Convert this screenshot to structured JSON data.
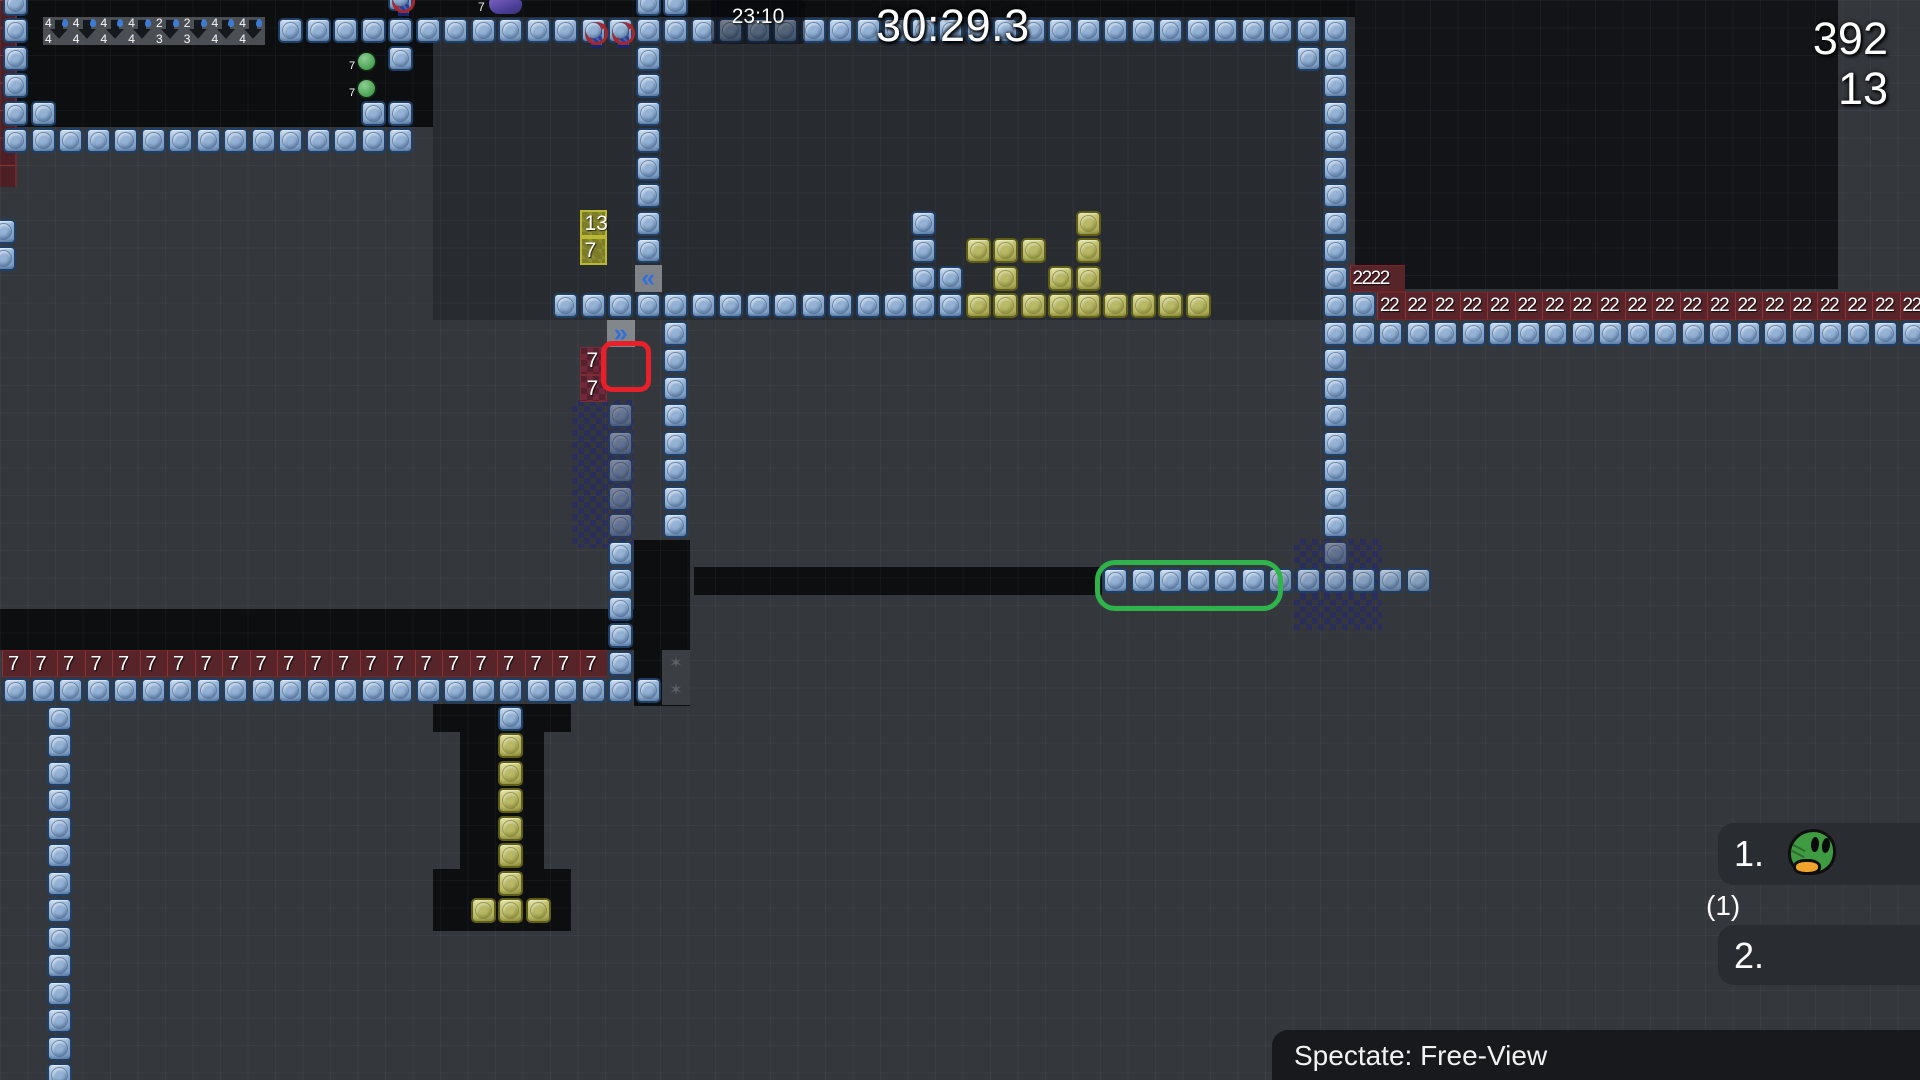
{
  "hud": {
    "clock": "23:10",
    "timer": "30:29.3",
    "counter_primary": "392",
    "counter_secondary": "13",
    "spectate_label": "Spectate: Free-View",
    "leaderboard": {
      "first_rank": "1.",
      "first_avatar": "green-duck",
      "first_sub": "(1)",
      "second_rank": "2."
    }
  },
  "colors": {
    "outer_bg": "#34373c",
    "central_room": "#282b30",
    "dark_room": "#0c0e10",
    "right_room": "#121417",
    "block_blue": "#9cb9da",
    "block_yellow": "#c5c573",
    "hazard_red": "#57242a",
    "checker_navy": "#262673",
    "accent_green": "#2fb34b",
    "accent_red": "#e8202a",
    "chevron_blue": "#2f6fe0",
    "duck_green": "#3f9b41",
    "beak_orange": "#f1a42c"
  },
  "map": {
    "tile": 27.5,
    "ox": 2,
    "oy": 17,
    "regions": [
      {
        "name": "top-strip",
        "x": 0,
        "y": 0,
        "w": 1838,
        "h": 17,
        "color": "#0c0e10"
      },
      {
        "name": "room-topleft",
        "x": 14,
        "y": 17,
        "w": 419,
        "h": 110,
        "color": "#0c0e10"
      },
      {
        "name": "room-central",
        "x": 433,
        "y": 17,
        "w": 890,
        "h": 303,
        "color": "#282b30"
      },
      {
        "name": "room-right",
        "x": 1355,
        "y": 0,
        "w": 483,
        "h": 289,
        "color": "#121417"
      },
      {
        "name": "strip-left",
        "x": 0,
        "y": 609,
        "w": 634,
        "h": 41,
        "color": "#0c0e10"
      },
      {
        "name": "pocket-mid",
        "x": 634,
        "y": 540,
        "w": 56,
        "h": 166,
        "color": "#0c0e10"
      },
      {
        "name": "corridor",
        "x": 694,
        "y": 567,
        "w": 408,
        "h": 28,
        "color": "#0c0e10"
      },
      {
        "name": "t-top",
        "x": 433,
        "y": 704,
        "w": 138,
        "h": 28,
        "color": "#0c0e10"
      },
      {
        "name": "t-shaft",
        "x": 460,
        "y": 732,
        "w": 84,
        "h": 166,
        "color": "#0c0e10"
      },
      {
        "name": "t-bottom",
        "x": 433,
        "y": 869,
        "w": 138,
        "h": 62,
        "color": "#0c0e10"
      }
    ],
    "checkers": [
      {
        "x": 572,
        "y": 400,
        "w": 62,
        "h": 148
      },
      {
        "x": 1294,
        "y": 539,
        "w": 88,
        "h": 29
      },
      {
        "x": 1294,
        "y": 567,
        "w": 88,
        "h": 28
      },
      {
        "x": 1294,
        "y": 594,
        "w": 88,
        "h": 36
      }
    ],
    "red_strip": {
      "x": 0,
      "y": 0,
      "w": 15,
      "h": 187
    },
    "arrow_strip": {
      "x": 43,
      "y": 17,
      "w": 222,
      "h": 28,
      "cells": [
        [
          "4",
          "4"
        ],
        [
          "4",
          "4"
        ],
        [
          "4",
          "4"
        ],
        [
          "4",
          "4"
        ],
        [
          "2",
          "3"
        ],
        [
          "2",
          "3"
        ],
        [
          "4",
          "4"
        ],
        [
          "4",
          "4"
        ]
      ]
    },
    "blue": [
      [
        0,
        -1
      ],
      [
        23,
        -1
      ],
      [
        24,
        -1
      ],
      [
        10,
        0
      ],
      [
        11,
        0
      ],
      [
        12,
        0
      ],
      [
        13,
        0
      ],
      [
        14,
        0
      ],
      [
        15,
        0
      ],
      [
        16,
        0
      ],
      [
        17,
        0
      ],
      [
        18,
        0
      ],
      [
        19,
        0
      ],
      [
        20,
        0
      ],
      [
        23,
        0
      ],
      [
        24,
        0
      ],
      [
        25,
        0
      ],
      [
        26,
        0
      ],
      [
        27,
        0
      ],
      [
        28,
        0
      ],
      [
        29,
        0
      ],
      [
        30,
        0
      ],
      [
        31,
        0
      ],
      [
        32,
        0
      ],
      [
        33,
        0
      ],
      [
        34,
        0
      ],
      [
        35,
        0
      ],
      [
        36,
        0
      ],
      [
        37,
        0
      ],
      [
        38,
        0
      ],
      [
        39,
        0
      ],
      [
        40,
        0
      ],
      [
        41,
        0
      ],
      [
        42,
        0
      ],
      [
        43,
        0
      ],
      [
        44,
        0
      ],
      [
        45,
        0
      ],
      [
        46,
        0
      ],
      [
        47,
        0
      ],
      [
        48,
        0
      ],
      [
        0,
        0
      ],
      [
        0,
        1
      ],
      [
        0,
        2
      ],
      [
        0,
        3
      ],
      [
        1,
        3
      ],
      [
        0,
        4
      ],
      [
        1,
        4
      ],
      [
        2,
        4
      ],
      [
        3,
        4
      ],
      [
        4,
        4
      ],
      [
        5,
        4
      ],
      [
        6,
        4
      ],
      [
        7,
        4
      ],
      [
        8,
        4
      ],
      [
        9,
        4
      ],
      [
        10,
        4
      ],
      [
        11,
        4
      ],
      [
        12,
        4
      ],
      [
        13,
        4
      ],
      [
        14,
        4
      ],
      [
        14,
        1
      ],
      [
        13,
        3
      ],
      [
        14,
        3
      ],
      [
        -0.45,
        7.3
      ],
      [
        -0.45,
        8.3
      ],
      [
        23,
        1
      ],
      [
        23,
        2
      ],
      [
        23,
        3
      ],
      [
        23,
        4
      ],
      [
        23,
        5
      ],
      [
        23,
        6
      ],
      [
        23,
        7
      ],
      [
        23,
        8
      ],
      [
        20,
        10
      ],
      [
        21,
        10
      ],
      [
        22,
        10
      ],
      [
        23,
        10
      ],
      [
        24,
        10
      ],
      [
        25,
        10
      ],
      [
        26,
        10
      ],
      [
        27,
        10
      ],
      [
        28,
        10
      ],
      [
        29,
        10
      ],
      [
        30,
        10
      ],
      [
        31,
        10
      ],
      [
        32,
        10
      ],
      [
        33,
        10
      ],
      [
        34,
        10
      ],
      [
        33,
        7
      ],
      [
        33,
        8
      ],
      [
        33,
        9
      ],
      [
        34,
        9
      ],
      [
        24,
        11
      ],
      [
        24,
        12
      ],
      [
        24,
        13
      ],
      [
        24,
        14
      ],
      [
        24,
        15
      ],
      [
        24,
        16
      ],
      [
        24,
        17
      ],
      [
        24,
        18
      ],
      [
        22,
        19
      ],
      [
        22,
        20
      ],
      [
        22,
        21
      ],
      [
        22,
        22
      ],
      [
        22,
        23
      ],
      [
        0,
        24
      ],
      [
        1,
        24
      ],
      [
        2,
        24
      ],
      [
        3,
        24
      ],
      [
        4,
        24
      ],
      [
        5,
        24
      ],
      [
        6,
        24
      ],
      [
        7,
        24
      ],
      [
        8,
        24
      ],
      [
        9,
        24
      ],
      [
        10,
        24
      ],
      [
        11,
        24
      ],
      [
        12,
        24
      ],
      [
        13,
        24
      ],
      [
        14,
        24
      ],
      [
        15,
        24
      ],
      [
        16,
        24
      ],
      [
        17,
        24
      ],
      [
        18,
        24
      ],
      [
        19,
        24
      ],
      [
        20,
        24
      ],
      [
        21,
        24
      ],
      [
        22,
        24
      ],
      [
        23,
        24
      ],
      [
        1.6,
        25
      ],
      [
        1.6,
        26
      ],
      [
        1.6,
        27
      ],
      [
        1.6,
        28
      ],
      [
        1.6,
        29
      ],
      [
        1.6,
        30
      ],
      [
        1.6,
        31
      ],
      [
        1.6,
        32
      ],
      [
        1.6,
        33
      ],
      [
        1.6,
        34
      ],
      [
        1.6,
        35
      ],
      [
        1.6,
        36
      ],
      [
        1.6,
        37
      ],
      [
        1.6,
        38
      ],
      [
        18,
        25
      ],
      [
        47,
        1
      ],
      [
        48,
        1
      ],
      [
        48,
        2
      ],
      [
        48,
        3
      ],
      [
        48,
        4
      ],
      [
        48,
        5
      ],
      [
        48,
        6
      ],
      [
        48,
        7
      ],
      [
        48,
        8
      ],
      [
        48,
        9
      ],
      [
        48,
        10
      ],
      [
        48,
        12
      ],
      [
        48,
        13
      ],
      [
        48,
        14
      ],
      [
        48,
        15
      ],
      [
        48,
        16
      ],
      [
        48,
        17
      ],
      [
        48,
        18
      ],
      [
        40,
        20
      ],
      [
        41,
        20
      ],
      [
        42,
        20
      ],
      [
        43,
        20
      ],
      [
        44,
        20
      ],
      [
        45,
        20
      ],
      [
        49,
        10
      ],
      [
        48,
        11
      ],
      [
        49,
        11
      ],
      [
        50,
        11
      ],
      [
        51,
        11
      ],
      [
        52,
        11
      ],
      [
        53,
        11
      ],
      [
        54,
        11
      ],
      [
        55,
        11
      ],
      [
        56,
        11
      ],
      [
        57,
        11
      ],
      [
        58,
        11
      ],
      [
        59,
        11
      ],
      [
        60,
        11
      ],
      [
        61,
        11
      ],
      [
        62,
        11
      ],
      [
        63,
        11
      ],
      [
        64,
        11
      ],
      [
        65,
        11
      ],
      [
        66,
        11
      ],
      [
        67,
        11
      ],
      [
        68,
        11
      ],
      [
        69,
        11
      ]
    ],
    "ghost": [
      [
        22,
        14
      ],
      [
        22,
        15
      ],
      [
        22,
        16
      ],
      [
        22,
        17
      ],
      [
        22,
        18
      ],
      [
        48,
        19
      ]
    ],
    "dim": [
      [
        46,
        20
      ],
      [
        47,
        20
      ],
      [
        48,
        20
      ],
      [
        49,
        20
      ],
      [
        50,
        20
      ],
      [
        51,
        20
      ]
    ],
    "yellow": [
      [
        35,
        10
      ],
      [
        36,
        10
      ],
      [
        37,
        10
      ],
      [
        38,
        10
      ],
      [
        39,
        10
      ],
      [
        40,
        10
      ],
      [
        41,
        10
      ],
      [
        42,
        10
      ],
      [
        43,
        10
      ],
      [
        39,
        7
      ],
      [
        35,
        8
      ],
      [
        36,
        8
      ],
      [
        37,
        8
      ],
      [
        39,
        8
      ],
      [
        36,
        9
      ],
      [
        38,
        9
      ],
      [
        39,
        9
      ],
      [
        18,
        26
      ],
      [
        18,
        27
      ],
      [
        18,
        28
      ],
      [
        18,
        29
      ],
      [
        18,
        30
      ],
      [
        18,
        31
      ],
      [
        17,
        32
      ],
      [
        18,
        32
      ],
      [
        19,
        32
      ]
    ],
    "noentry": [
      [
        21,
        0
      ],
      [
        22,
        0
      ],
      [
        14,
        -1.15
      ]
    ],
    "hazard_row7": {
      "row": 23,
      "from": 0,
      "to": 21,
      "label": "7"
    },
    "hazard_row2": {
      "row": 10,
      "from": 50,
      "to": 69,
      "label": "22"
    },
    "hazard_box": {
      "c": 49,
      "r": 9,
      "w": 2,
      "label": "2222"
    },
    "olive_labels": [
      [
        21,
        7,
        "13"
      ],
      [
        21,
        8,
        "7"
      ]
    ],
    "red_labels": [
      [
        21,
        12,
        "7"
      ],
      [
        21,
        13,
        "7"
      ]
    ],
    "chevrons": [
      [
        23,
        9,
        "«"
      ],
      [
        22,
        11,
        "»"
      ]
    ],
    "stars": [
      [
        24,
        23,
        "✶"
      ],
      [
        24,
        24,
        "✶"
      ]
    ],
    "green_dots": [
      {
        "x": 358,
        "y": 53,
        "label": "7"
      },
      {
        "x": 358,
        "y": 80,
        "label": "7"
      }
    ],
    "creature": {
      "x": 489,
      "y": 0,
      "w": 33,
      "h": 14,
      "label": "7"
    },
    "outline_red": {
      "x": 601,
      "y": 341,
      "w": 40,
      "h": 41
    },
    "outline_green": {
      "x": 1095,
      "y": 560,
      "w": 178,
      "h": 41
    }
  }
}
